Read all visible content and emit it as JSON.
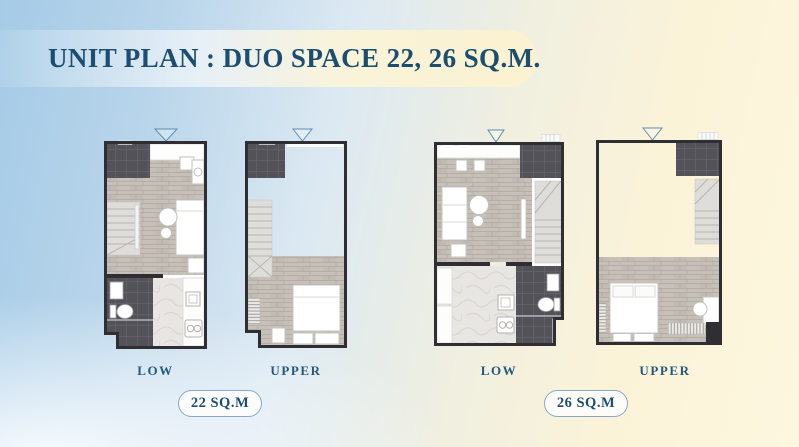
{
  "header": {
    "title": "UNIT PLAN : DUO SPACE 22, 26 SQ.M."
  },
  "units": [
    {
      "badge": "22 SQ.M",
      "plans": [
        {
          "label": "LOW"
        },
        {
          "label": "UPPER"
        }
      ]
    },
    {
      "badge": "26 SQ.M",
      "plans": [
        {
          "label": "LOW"
        },
        {
          "label": "UPPER"
        }
      ]
    }
  ],
  "colors": {
    "title_text": "#1b4e71",
    "level_label_text": "#23597e",
    "badge_border": "#84aac8",
    "badge_background": "#fdfdfb",
    "wall": "#2e2e33",
    "balcony_tile": "#525258",
    "wood_floor": "#c7c0b8",
    "marble_floor": "#e8e6e2",
    "stairs": "#dfddd9",
    "door_swing": "#5b8fae",
    "background_blue": "#a5cbe6",
    "background_cream": "#fdf6dd"
  }
}
